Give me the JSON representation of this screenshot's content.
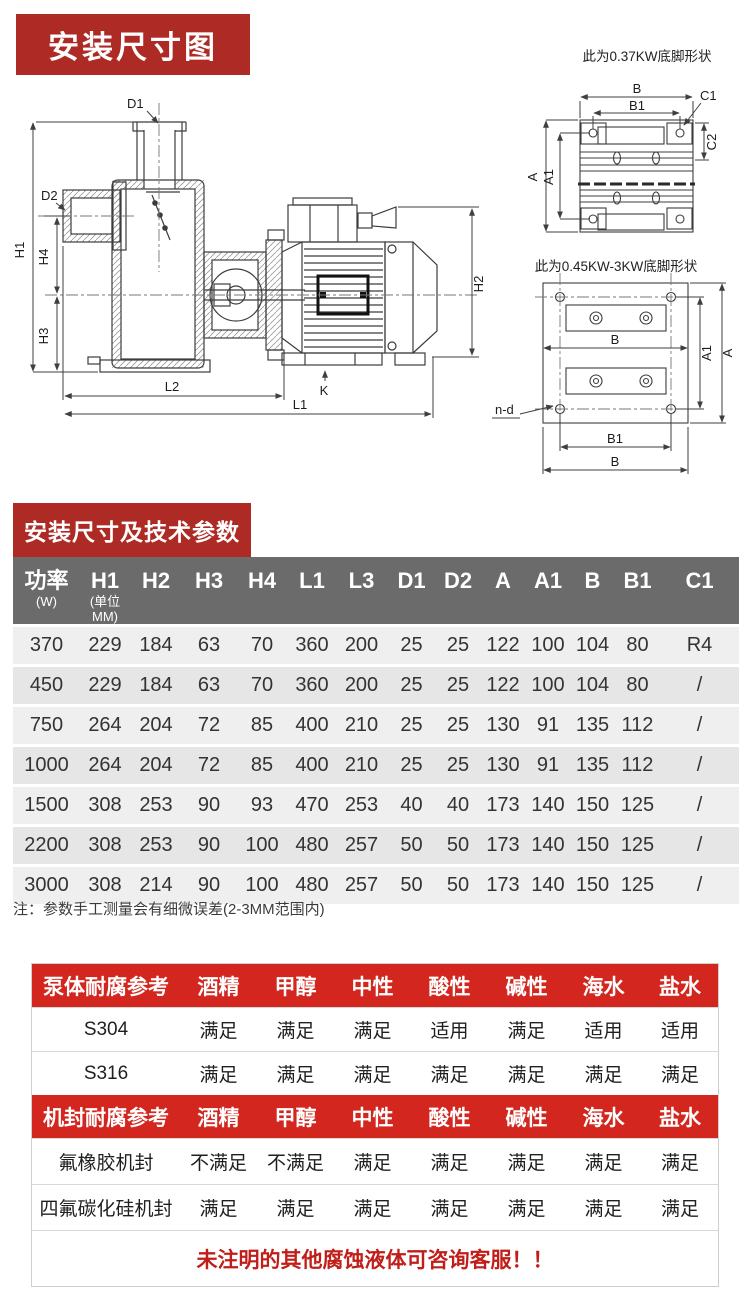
{
  "colors": {
    "badge_red": "#ae2a24",
    "table_header_bg": "#6b6b6b",
    "corrosion_header_bg": "#d2261e",
    "notice_text": "#c11e19",
    "row_a": "#efefef",
    "row_b": "#e6e6e6"
  },
  "section_dimensions": {
    "title": "安装尺寸图"
  },
  "drawing": {
    "pump": {
      "d1": "D1",
      "d2": "D2",
      "h1": "H1",
      "h2": "H2",
      "h3": "H3",
      "h4": "H4",
      "l1": "L1",
      "l2": "L2",
      "k": "K"
    },
    "foot_small": {
      "title": "此为0.37KW底脚形状",
      "a": "A",
      "a1": "A1",
      "b": "B",
      "b1": "B1",
      "c1": "C1",
      "c2": "C2"
    },
    "foot_large": {
      "title": "此为0.45KW-3KW底脚形状",
      "a": "A",
      "a1": "A1",
      "b_mid": "B",
      "b1": "B1",
      "b_bottom": "B",
      "n_d": "n-d"
    }
  },
  "section_params": {
    "title": "安装尺寸及技术参数",
    "note": "注：参数手工测量会有细微误差(2-3MM范围内)"
  },
  "params_table": {
    "headers": [
      {
        "label": "功率",
        "sub": "(W)"
      },
      {
        "label": "H1",
        "sub": "(单位MM)"
      },
      {
        "label": "H2"
      },
      {
        "label": "H3"
      },
      {
        "label": "H4"
      },
      {
        "label": "L1"
      },
      {
        "label": "L3"
      },
      {
        "label": "D1"
      },
      {
        "label": "D2"
      },
      {
        "label": "A"
      },
      {
        "label": "A1"
      },
      {
        "label": "B"
      },
      {
        "label": "B1"
      },
      {
        "label": "C1"
      }
    ],
    "rows": [
      [
        "370",
        "229",
        "184",
        "63",
        "70",
        "360",
        "200",
        "25",
        "25",
        "122",
        "100",
        "104",
        "80",
        "R4"
      ],
      [
        "450",
        "229",
        "184",
        "63",
        "70",
        "360",
        "200",
        "25",
        "25",
        "122",
        "100",
        "104",
        "80",
        "/"
      ],
      [
        "750",
        "264",
        "204",
        "72",
        "85",
        "400",
        "210",
        "25",
        "25",
        "130",
        "91",
        "135",
        "112",
        "/"
      ],
      [
        "1000",
        "264",
        "204",
        "72",
        "85",
        "400",
        "210",
        "25",
        "25",
        "130",
        "91",
        "135",
        "112",
        "/"
      ],
      [
        "1500",
        "308",
        "253",
        "90",
        "93",
        "470",
        "253",
        "40",
        "40",
        "173",
        "140",
        "150",
        "125",
        "/"
      ],
      [
        "2200",
        "308",
        "253",
        "90",
        "100",
        "480",
        "257",
        "50",
        "50",
        "173",
        "140",
        "150",
        "125",
        "/"
      ],
      [
        "3000",
        "308",
        "214",
        "90",
        "100",
        "480",
        "257",
        "50",
        "50",
        "173",
        "140",
        "150",
        "125",
        "/"
      ]
    ]
  },
  "corrosion_table": {
    "header_pump": [
      "泵体耐腐参考",
      "酒精",
      "甲醇",
      "中性",
      "酸性",
      "碱性",
      "海水",
      "盐水"
    ],
    "rows_pump": [
      [
        "S304",
        "满足",
        "满足",
        "满足",
        "适用",
        "满足",
        "适用",
        "适用"
      ],
      [
        "S316",
        "满足",
        "满足",
        "满足",
        "满足",
        "满足",
        "满足",
        "满足"
      ]
    ],
    "header_seal": [
      "机封耐腐参考",
      "酒精",
      "甲醇",
      "中性",
      "酸性",
      "碱性",
      "海水",
      "盐水"
    ],
    "rows_seal": [
      [
        "氟橡胶机封",
        "不满足",
        "不满足",
        "满足",
        "满足",
        "满足",
        "满足",
        "满足"
      ],
      [
        "四氟碳化硅机封",
        "满足",
        "满足",
        "满足",
        "满足",
        "满足",
        "满足",
        "满足"
      ]
    ],
    "notice": "未注明的其他腐蚀液体可咨询客服！！"
  }
}
